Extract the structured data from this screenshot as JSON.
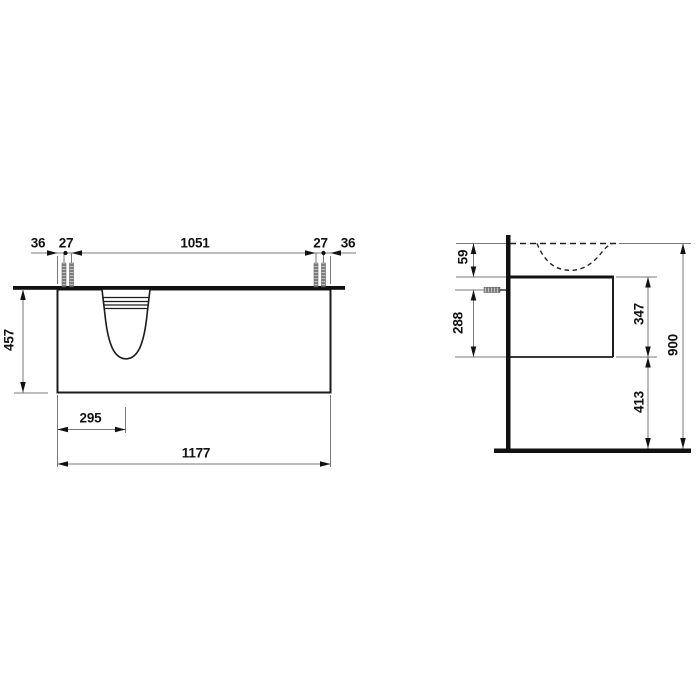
{
  "colors": {
    "line": "#111111",
    "thin_line": "#7a7a7a",
    "background": "#ffffff"
  },
  "front_view": {
    "dims": {
      "left_edge_to_bolt": "36",
      "left_bolt_gap": "27",
      "bolt_span": "1051",
      "right_bolt_gap": "27",
      "right_edge_to_bolt": "36",
      "cabinet_height": "457",
      "basin_center_from_left": "295",
      "total_width": "1177"
    }
  },
  "side_view": {
    "dims": {
      "rim_to_cabinet_top": "59",
      "screw_to_cabinet_bottom": "288",
      "cabinet_height": "347",
      "cabinet_bottom_to_floor": "413",
      "total_height": "900"
    }
  }
}
